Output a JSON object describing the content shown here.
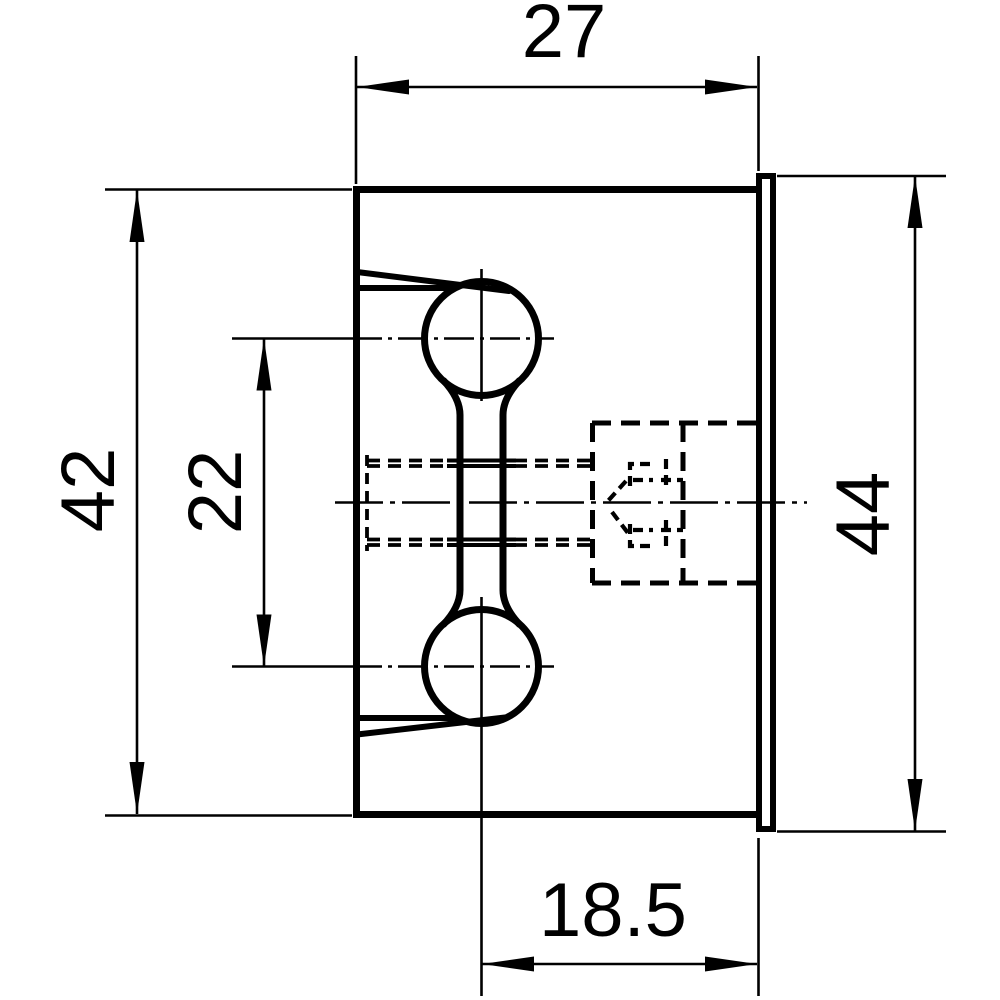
{
  "drawing": {
    "background_color": "#ffffff",
    "ink_color": "#000000",
    "dimensions": {
      "top_width": "27",
      "left_outer_height": "42",
      "left_inner_height": "22",
      "right_height": "44",
      "bottom_width": "18.5"
    }
  }
}
